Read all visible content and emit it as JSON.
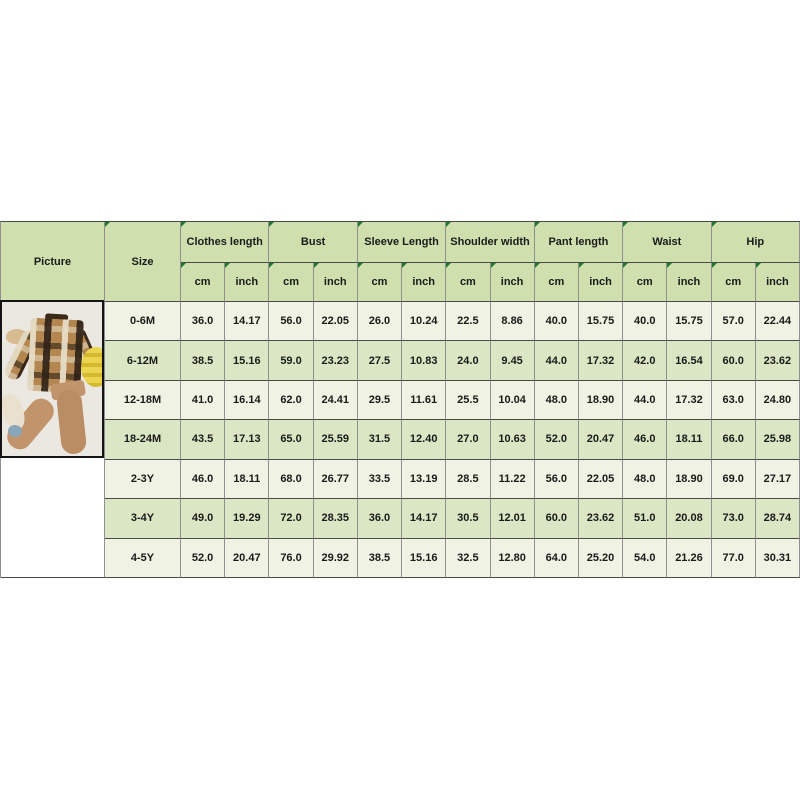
{
  "table": {
    "picture_header": "Picture",
    "size_header": "Size",
    "groups": [
      "Clothes length",
      "Bust",
      "Sleeve Length",
      "Shoulder width",
      "Pant length",
      "Waist",
      "Hip"
    ],
    "units": [
      "cm",
      "inch"
    ],
    "rows": [
      {
        "size": "0-6M",
        "values": [
          "36.0",
          "14.17",
          "56.0",
          "22.05",
          "26.0",
          "10.24",
          "22.5",
          "8.86",
          "40.0",
          "15.75",
          "40.0",
          "15.75",
          "57.0",
          "22.44"
        ]
      },
      {
        "size": "6-12M",
        "values": [
          "38.5",
          "15.16",
          "59.0",
          "23.23",
          "27.5",
          "10.83",
          "24.0",
          "9.45",
          "44.0",
          "17.32",
          "42.0",
          "16.54",
          "60.0",
          "23.62"
        ]
      },
      {
        "size": "12-18M",
        "values": [
          "41.0",
          "16.14",
          "62.0",
          "24.41",
          "29.5",
          "11.61",
          "25.5",
          "10.04",
          "48.0",
          "18.90",
          "44.0",
          "17.32",
          "63.0",
          "24.80"
        ]
      },
      {
        "size": "18-24M",
        "values": [
          "43.5",
          "17.13",
          "65.0",
          "25.59",
          "31.5",
          "12.40",
          "27.0",
          "10.63",
          "52.0",
          "20.47",
          "46.0",
          "18.11",
          "66.0",
          "25.98"
        ]
      },
      {
        "size": "2-3Y",
        "values": [
          "46.0",
          "18.11",
          "68.0",
          "26.77",
          "33.5",
          "13.19",
          "28.5",
          "11.22",
          "56.0",
          "22.05",
          "48.0",
          "18.90",
          "69.0",
          "27.17"
        ]
      },
      {
        "size": "3-4Y",
        "values": [
          "49.0",
          "19.29",
          "72.0",
          "28.35",
          "36.0",
          "14.17",
          "30.5",
          "12.01",
          "60.0",
          "23.62",
          "51.0",
          "20.08",
          "73.0",
          "28.74"
        ]
      },
      {
        "size": "4-5Y",
        "values": [
          "52.0",
          "20.47",
          "76.0",
          "29.92",
          "38.5",
          "15.16",
          "32.5",
          "12.80",
          "64.0",
          "25.20",
          "54.0",
          "21.26",
          "77.0",
          "30.31"
        ]
      }
    ],
    "colors": {
      "header_bg": "#cfe0ae",
      "row_light": "#f0f2e3",
      "row_green": "#dbe7c4",
      "grid_vertical": "#909090",
      "grid_horizontal": "#4a4a4a",
      "flag_triangle": "#1e7a2e",
      "text": "#1a1a1a"
    }
  },
  "photo": {
    "alt": "Flat-lay product photo: brown plaid button-up shirt with tan jogger pants, teddy bear, bunny plush and yellow hat",
    "colors": {
      "background": "#eae8e1",
      "shirt_base": "#b3874f",
      "shirt_dark": "#2e2116",
      "shirt_cream": "#e6dcc6",
      "pants": "#c2946c",
      "hat": "#ecd54e",
      "bear": "#d9bb92",
      "bunny": "#e9e0cd"
    }
  }
}
